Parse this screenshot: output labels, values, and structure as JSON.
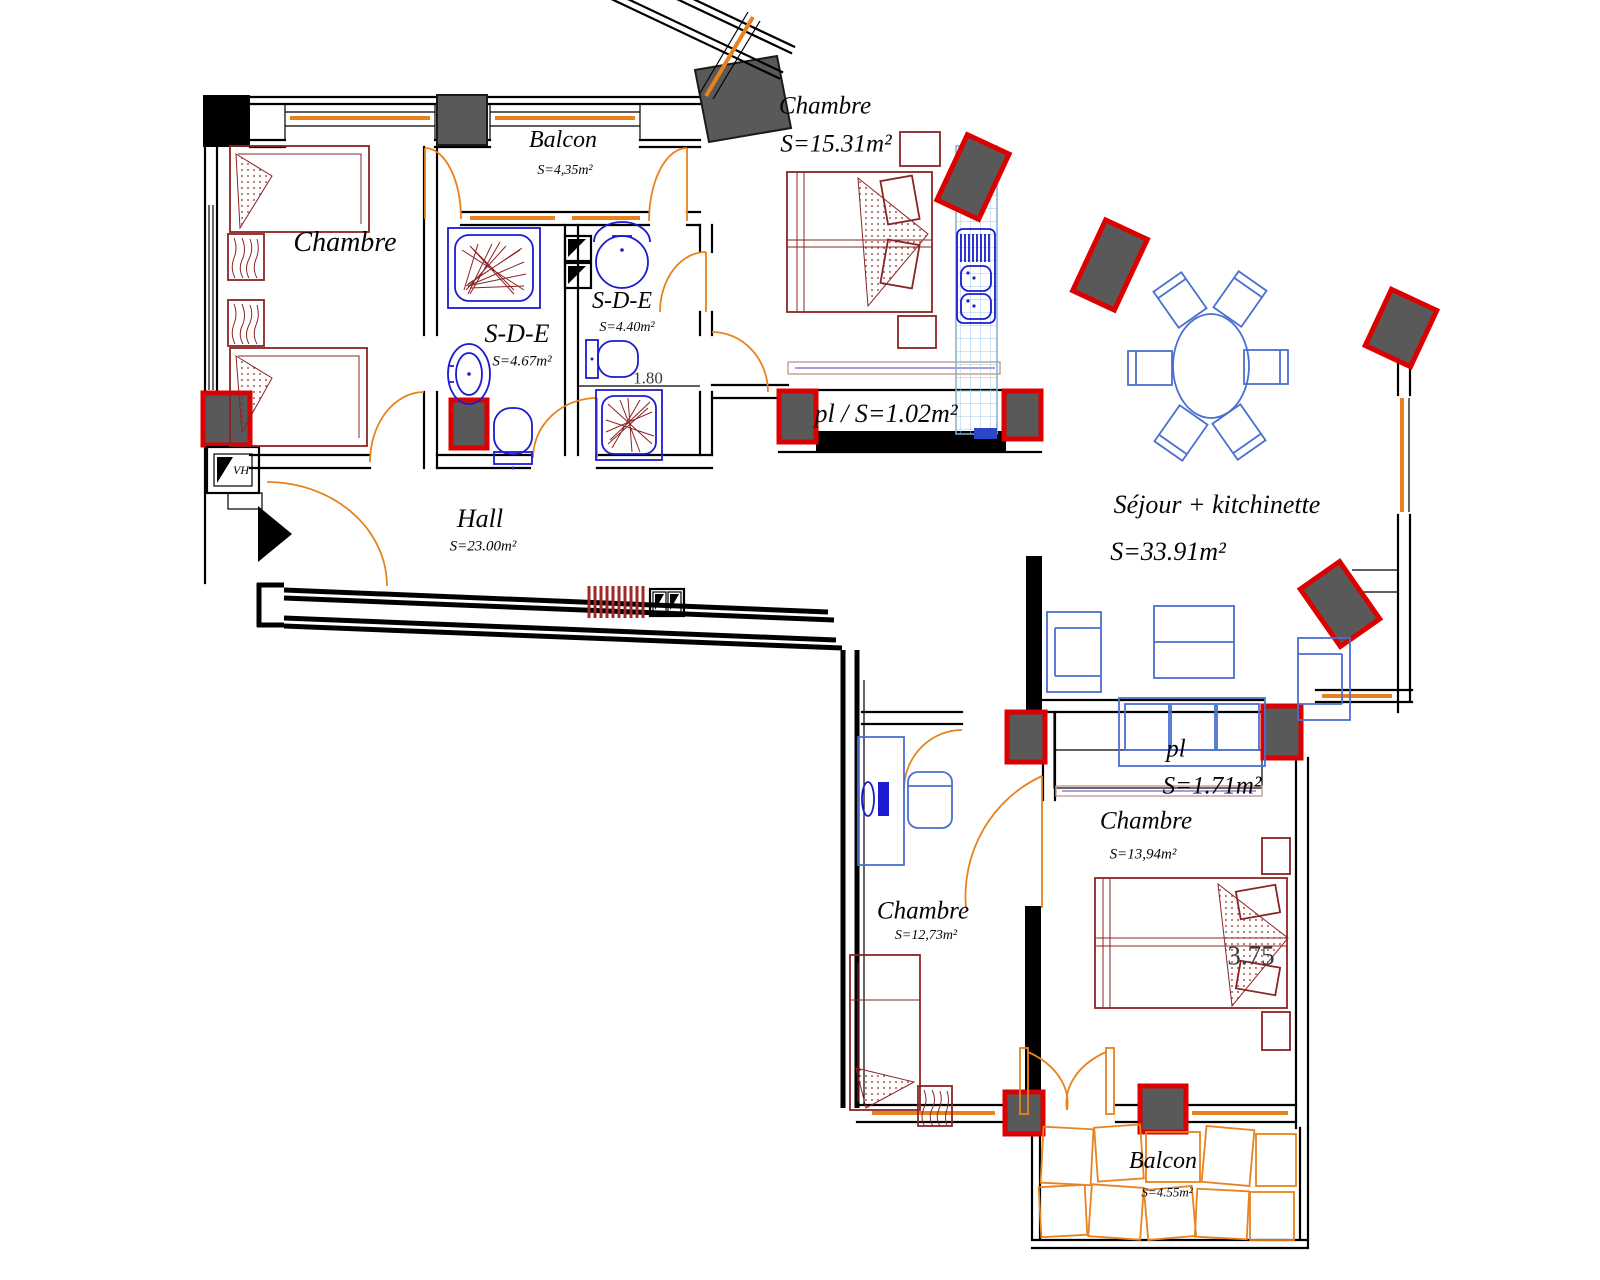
{
  "rooms": [
    {
      "id": "chambre-top-left",
      "name": "Chambre",
      "area": ""
    },
    {
      "id": "balcon-top",
      "name": "Balcon",
      "area": "S=4,35m²"
    },
    {
      "id": "sde-left",
      "name": "S-D-E",
      "area": "S=4.67m²"
    },
    {
      "id": "sde-right",
      "name": "S-D-E",
      "area": "S=4.40m²"
    },
    {
      "id": "chambre-top-right",
      "name": "Chambre",
      "area": "S=15.31m²"
    },
    {
      "id": "closet-hall",
      "name": "pl / S=1.02m²",
      "area": ""
    },
    {
      "id": "sejour",
      "name": "Séjour + kitchinette",
      "area": "S=33.91m²"
    },
    {
      "id": "hall",
      "name": "Hall",
      "area": "S=23.00m²"
    },
    {
      "id": "closet-bottom",
      "name": "pl",
      "area": "S=1.71m²"
    },
    {
      "id": "chambre-bottom-right",
      "name": "Chambre",
      "area": "S=13,94m²"
    },
    {
      "id": "chambre-bottom-left",
      "name": "Chambre",
      "area": "S=12,73m²"
    },
    {
      "id": "balcon-bottom",
      "name": "Balcon",
      "area": "S=4.55m²"
    }
  ],
  "dimensions": [
    {
      "id": "shower-width",
      "text": "1.80"
    },
    {
      "id": "bed-width",
      "text": "3.75"
    }
  ],
  "shaft_label": "VH",
  "colors": {
    "wall": "#000000",
    "pillar_fill": "#595959",
    "pillar_accent": "#dd0000",
    "furniture_red": "#8b2424",
    "sanitary_blue": "#1b1bd1",
    "furnishing_blue": "#4a6fd1",
    "kitchen_grid_blue": "#a5cae4",
    "joinery_orange": "#e8821e",
    "sliding_purple": "#8f7fd4",
    "dim_text": "#3a3a3a"
  }
}
